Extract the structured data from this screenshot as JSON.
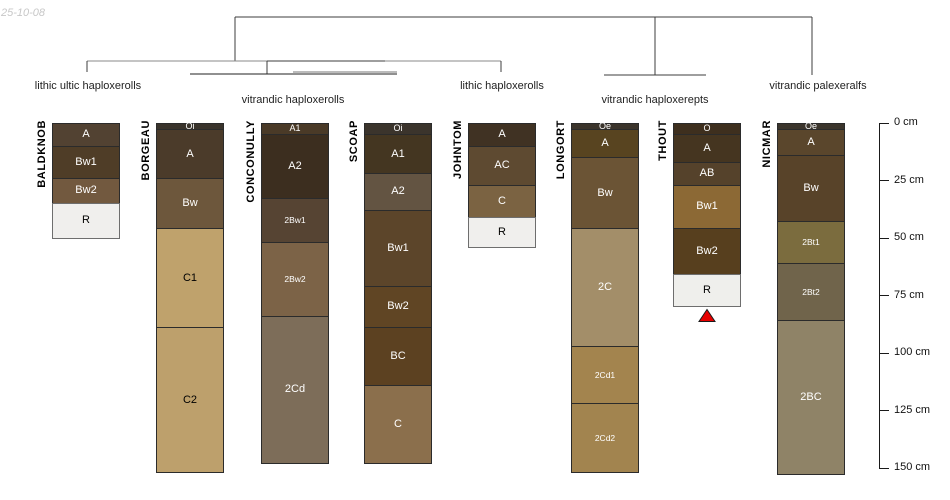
{
  "date_stamp": "25-10-08",
  "chart_data": {
    "type": "soil-profile-dendrogram",
    "depth_unit": "cm",
    "dendrogram": {
      "taxa_labels": [
        {
          "label": "lithic ultic haploxerolls",
          "x": 88,
          "y": 80
        },
        {
          "label": "vitrandic haploxerolls",
          "x": 293,
          "y": 94
        },
        {
          "label": "lithic haploxerolls",
          "x": 502,
          "y": 80
        },
        {
          "label": "vitrandic haploxerepts",
          "x": 655,
          "y": 94
        },
        {
          "label": "vitrandic palexeralfs",
          "x": 818,
          "y": 80
        }
      ],
      "segments": [
        {
          "x1": 235,
          "y1": 17,
          "x2": 812,
          "y2": 17,
          "color": "#3c3c3c"
        },
        {
          "x1": 235,
          "y1": 17,
          "x2": 235,
          "y2": 61,
          "color": "#3c3c3c"
        },
        {
          "x1": 655,
          "y1": 17,
          "x2": 655,
          "y2": 75,
          "color": "#3c3c3c"
        },
        {
          "x1": 812,
          "y1": 17,
          "x2": 812,
          "y2": 75,
          "color": "#3c3c3c"
        },
        {
          "x1": 604,
          "y1": 75,
          "x2": 706,
          "y2": 75,
          "color": "#3c3c3c"
        },
        {
          "x1": 87,
          "y1": 61,
          "x2": 501,
          "y2": 61,
          "color": "#8a8a8a"
        },
        {
          "x1": 267,
          "y1": 61,
          "x2": 385,
          "y2": 61,
          "color": "#3c3c3c"
        },
        {
          "x1": 87,
          "y1": 61,
          "x2": 87,
          "y2": 72,
          "color": "#3c3c3c"
        },
        {
          "x1": 501,
          "y1": 61,
          "x2": 501,
          "y2": 72,
          "color": "#3c3c3c"
        },
        {
          "x1": 267,
          "y1": 61,
          "x2": 267,
          "y2": 74,
          "color": "#3c3c3c"
        },
        {
          "x1": 190,
          "y1": 74,
          "x2": 397,
          "y2": 74,
          "color": "#222222"
        },
        {
          "x1": 293,
          "y1": 72,
          "x2": 397,
          "y2": 72,
          "color": "#777777"
        }
      ]
    },
    "depth_axis": {
      "ticks": [
        {
          "value": 0,
          "label": "0 cm"
        },
        {
          "value": 25,
          "label": "25 cm"
        },
        {
          "value": 50,
          "label": "50 cm"
        },
        {
          "value": 75,
          "label": "75 cm"
        },
        {
          "value": 100,
          "label": "100 cm"
        },
        {
          "value": 125,
          "label": "125 cm"
        },
        {
          "value": 150,
          "label": "150 cm"
        }
      ]
    },
    "profiles": [
      {
        "name": "BALDKNOB",
        "horizons": [
          {
            "label": "A",
            "top": 0,
            "bottom": 10,
            "color": "#524232",
            "text_color": "#ffffff"
          },
          {
            "label": "Bw1",
            "top": 10,
            "bottom": 24,
            "color": "#4f3d27",
            "text_color": "#ffffff"
          },
          {
            "label": "Bw2",
            "top": 24,
            "bottom": 35,
            "color": "#72593f",
            "text_color": "#ffffff"
          },
          {
            "label": "R",
            "top": 35,
            "bottom": 50,
            "color": "#f0efed",
            "text_color": "#000000",
            "bedrock": true
          }
        ]
      },
      {
        "name": "BORGEAU",
        "horizons": [
          {
            "label": "Oi",
            "top": 0,
            "bottom": 3,
            "color": "#39332b",
            "text_color": "#ffffff"
          },
          {
            "label": "A",
            "top": 3,
            "bottom": 24,
            "color": "#4b3b2a",
            "text_color": "#ffffff"
          },
          {
            "label": "Bw",
            "top": 24,
            "bottom": 46,
            "color": "#6d573c",
            "text_color": "#ffffff"
          },
          {
            "label": "C1",
            "top": 46,
            "bottom": 89,
            "color": "#bfa26c",
            "text_color": "#000000"
          },
          {
            "label": "C2",
            "top": 89,
            "bottom": 152,
            "color": "#bda06c",
            "text_color": "#000000"
          }
        ]
      },
      {
        "name": "CONCONULLY",
        "horizons": [
          {
            "label": "A1",
            "top": 0,
            "bottom": 5,
            "color": "#4a3a27",
            "text_color": "#ffffff"
          },
          {
            "label": "A2",
            "top": 5,
            "bottom": 33,
            "color": "#3c2e1f",
            "text_color": "#ffffff"
          },
          {
            "label": "2Bw1",
            "top": 33,
            "bottom": 52,
            "color": "#564433",
            "text_color": "#ffffff"
          },
          {
            "label": "2Bw2",
            "top": 52,
            "bottom": 84,
            "color": "#7c6347",
            "text_color": "#ffffff"
          },
          {
            "label": "2Cd",
            "top": 84,
            "bottom": 148,
            "color": "#7d6d59",
            "text_color": "#ffffff"
          }
        ]
      },
      {
        "name": "SCOAP",
        "horizons": [
          {
            "label": "Oi",
            "top": 0,
            "bottom": 5,
            "color": "#3b342c",
            "text_color": "#ffffff"
          },
          {
            "label": "A1",
            "top": 5,
            "bottom": 22,
            "color": "#443621",
            "text_color": "#ffffff"
          },
          {
            "label": "A2",
            "top": 22,
            "bottom": 38,
            "color": "#635442",
            "text_color": "#ffffff"
          },
          {
            "label": "Bw1",
            "top": 38,
            "bottom": 71,
            "color": "#5c452a",
            "text_color": "#ffffff"
          },
          {
            "label": "Bw2",
            "top": 71,
            "bottom": 89,
            "color": "#604524",
            "text_color": "#ffffff"
          },
          {
            "label": "BC",
            "top": 89,
            "bottom": 114,
            "color": "#5c4121",
            "text_color": "#ffffff"
          },
          {
            "label": "C",
            "top": 114,
            "bottom": 148,
            "color": "#8b6f4c",
            "text_color": "#ffffff"
          }
        ]
      },
      {
        "name": "JOHNTOM",
        "horizons": [
          {
            "label": "A",
            "top": 0,
            "bottom": 10,
            "color": "#403223",
            "text_color": "#ffffff"
          },
          {
            "label": "AC",
            "top": 10,
            "bottom": 27,
            "color": "#5e4a31",
            "text_color": "#ffffff"
          },
          {
            "label": "C",
            "top": 27,
            "bottom": 41,
            "color": "#7b6342",
            "text_color": "#ffffff"
          },
          {
            "label": "R",
            "top": 41,
            "bottom": 54,
            "color": "#f0efed",
            "text_color": "#000000",
            "bedrock": true
          }
        ]
      },
      {
        "name": "LONGORT",
        "horizons": [
          {
            "label": "Oe",
            "top": 0,
            "bottom": 3,
            "color": "#3b342b",
            "text_color": "#ffffff"
          },
          {
            "label": "A",
            "top": 3,
            "bottom": 15,
            "color": "#584420",
            "text_color": "#ffffff"
          },
          {
            "label": "Bw",
            "top": 15,
            "bottom": 46,
            "color": "#6b5435",
            "text_color": "#ffffff"
          },
          {
            "label": "2C",
            "top": 46,
            "bottom": 97,
            "color": "#a38e69",
            "text_color": "#ffffff"
          },
          {
            "label": "2Cd1",
            "top": 97,
            "bottom": 122,
            "color": "#a3844e",
            "text_color": "#ffffff"
          },
          {
            "label": "2Cd2",
            "top": 122,
            "bottom": 152,
            "color": "#a2844f",
            "text_color": "#ffffff"
          }
        ]
      },
      {
        "name": "THOUT",
        "horizons": [
          {
            "label": "O",
            "top": 0,
            "bottom": 5,
            "color": "#3e2f1e",
            "text_color": "#ffffff"
          },
          {
            "label": "A",
            "top": 5,
            "bottom": 17,
            "color": "#453520",
            "text_color": "#ffffff"
          },
          {
            "label": "AB",
            "top": 17,
            "bottom": 27,
            "color": "#55422b",
            "text_color": "#ffffff"
          },
          {
            "label": "Bw1",
            "top": 27,
            "bottom": 46,
            "color": "#8c6935",
            "text_color": "#ffffff"
          },
          {
            "label": "Bw2",
            "top": 46,
            "bottom": 66,
            "color": "#573f1e",
            "text_color": "#ffffff"
          },
          {
            "label": "R",
            "top": 66,
            "bottom": 80,
            "color": "#efefec",
            "text_color": "#000000",
            "bedrock": true
          }
        ]
      },
      {
        "name": "NICMAR",
        "horizons": [
          {
            "label": "Oe",
            "top": 0,
            "bottom": 3,
            "color": "#3b352c",
            "text_color": "#ffffff"
          },
          {
            "label": "A",
            "top": 3,
            "bottom": 14,
            "color": "#5a462c",
            "text_color": "#ffffff"
          },
          {
            "label": "Bw",
            "top": 14,
            "bottom": 43,
            "color": "#584329",
            "text_color": "#ffffff"
          },
          {
            "label": "2Bt1",
            "top": 43,
            "bottom": 61,
            "color": "#7b6c3e",
            "text_color": "#ffffff"
          },
          {
            "label": "2Bt2",
            "top": 61,
            "bottom": 86,
            "color": "#70644b",
            "text_color": "#ffffff"
          },
          {
            "label": "2BC",
            "top": 86,
            "bottom": 153,
            "color": "#8f8367",
            "text_color": "#ffffff"
          }
        ]
      }
    ],
    "marker": {
      "profile": "THOUT",
      "below_depth_cm": 80,
      "shape": "triangle-up",
      "fill": "#e60000",
      "stroke": "#1a1a1a"
    }
  }
}
